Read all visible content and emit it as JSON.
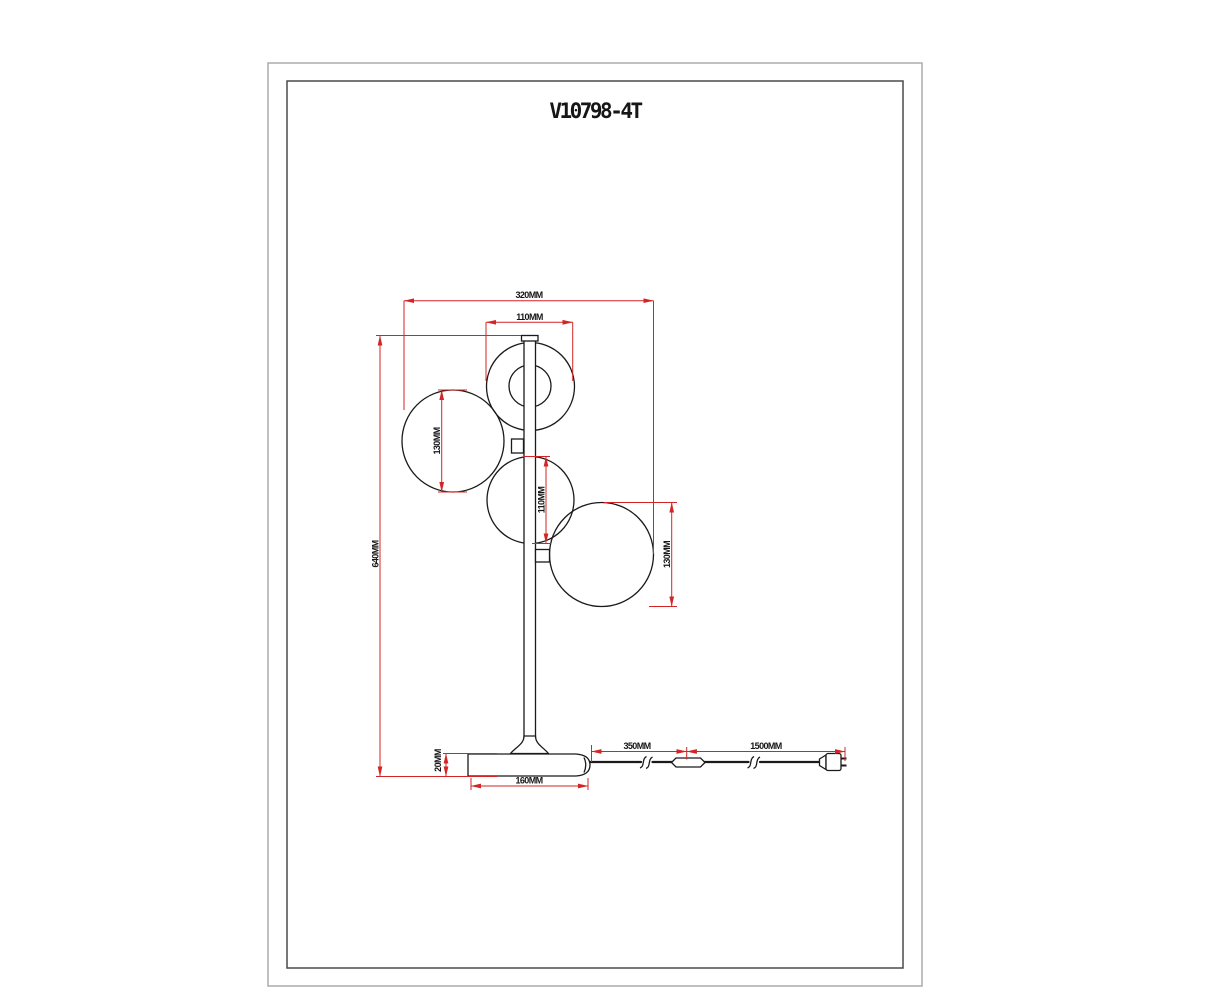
{
  "drawing": {
    "model": "V10798-4T",
    "dims": {
      "overall_width": "320MM",
      "top_globe_width": "110MM",
      "overall_height": "640MM",
      "left_globe_dia": "130MM",
      "middle_globe_dia": "110MM",
      "right_globe_dia": "130MM",
      "base_thickness": "20MM",
      "base_width": "160MM",
      "cord_base_to_switch": "350MM",
      "cord_switch_to_plug": "1500MM"
    },
    "colors": {
      "dimension_red": "#d32525",
      "outline_black": "#1a1a1a",
      "outer_frame": "#ababab",
      "inner_frame": "#4a4a4a"
    }
  }
}
